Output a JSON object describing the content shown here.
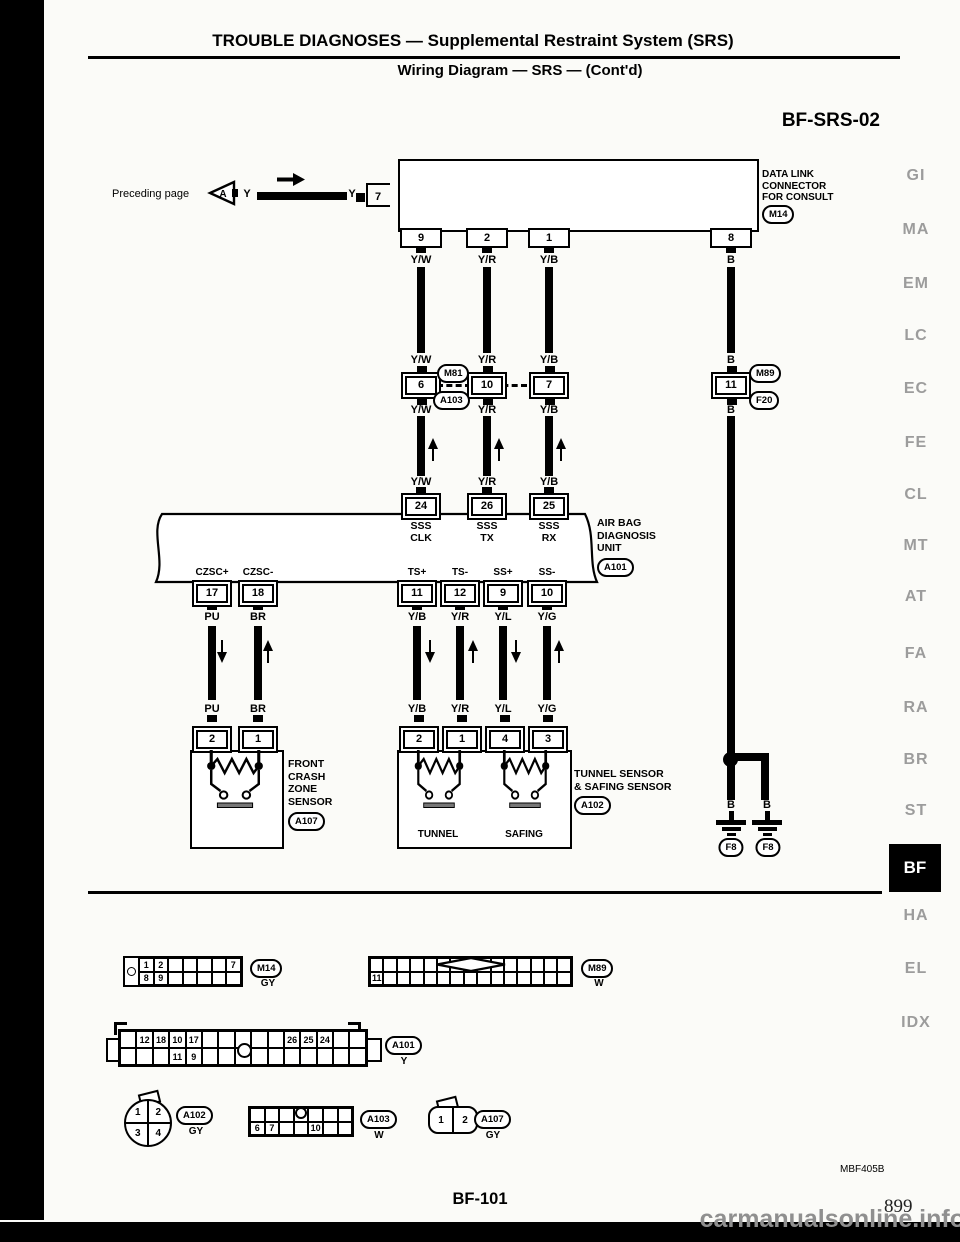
{
  "header": {
    "title": "TROUBLE DIAGNOSES — Supplemental Restraint System (SRS)",
    "subtitle": "Wiring Diagram — SRS — (Cont'd)",
    "diagram_code": "BF-SRS-02"
  },
  "margin_tabs": [
    {
      "label": "GI"
    },
    {
      "label": "MA"
    },
    {
      "label": "EM"
    },
    {
      "label": "LC"
    },
    {
      "label": "EC"
    },
    {
      "label": "FE"
    },
    {
      "label": "CL"
    },
    {
      "label": "MT"
    },
    {
      "label": "AT"
    },
    {
      "label": "FA"
    },
    {
      "label": "RA"
    },
    {
      "label": "BR"
    },
    {
      "label": "ST"
    },
    {
      "label": "BF"
    },
    {
      "label": "HA"
    },
    {
      "label": "EL"
    },
    {
      "label": "IDX"
    }
  ],
  "preceding": {
    "label": "Preceding page",
    "ref": "A",
    "wire_color": "Y",
    "wire_color2": "Y",
    "pin": "7"
  },
  "datalink": {
    "label": "DATA LINK\nCONNECTOR\nFOR CONSULT",
    "id": "M14"
  },
  "columns": [
    {
      "pin": "9",
      "color": "Y/W",
      "splice_pin": "6",
      "unit_pin": "24",
      "signal": "SSS\nCLK"
    },
    {
      "pin": "2",
      "color": "Y/R",
      "splice_pin": "10",
      "unit_pin": "26",
      "signal": "SSS\nTX"
    },
    {
      "pin": "1",
      "color": "Y/B",
      "splice_pin": "7",
      "unit_pin": "25",
      "signal": "SSS\nRX"
    },
    {
      "pin": "8",
      "color": "B",
      "splice_pin": "11"
    }
  ],
  "splice_ids": {
    "top": "M81",
    "bottom": "A103"
  },
  "right_splice_ids": {
    "top": "M89",
    "bottom": "F20"
  },
  "unit": {
    "name": "AIR BAG\nDIAGNOSIS\nUNIT",
    "id": "A101"
  },
  "unit_bottom": [
    {
      "signal": "CZSC+",
      "pin": "17",
      "color": "PU",
      "sensor_pin": "2"
    },
    {
      "signal": "CZSC-",
      "pin": "18",
      "color": "BR",
      "sensor_pin": "1"
    },
    {
      "signal": "TS+",
      "pin": "11",
      "color": "Y/B",
      "sensor_pin": "2"
    },
    {
      "signal": "TS-",
      "pin": "12",
      "color": "Y/R",
      "sensor_pin": "1"
    },
    {
      "signal": "SS+",
      "pin": "9",
      "color": "Y/L",
      "sensor_pin": "4"
    },
    {
      "signal": "SS-",
      "pin": "10",
      "color": "Y/G",
      "sensor_pin": "3"
    }
  ],
  "sensors": {
    "front": {
      "name": "FRONT\nCRASH\nZONE\nSENSOR",
      "id": "A107"
    },
    "tunnel": {
      "name": "TUNNEL SENSOR\n& SAFING SENSOR",
      "id": "A102",
      "sub_labels": [
        "TUNNEL",
        "SAFING"
      ]
    }
  },
  "ground": {
    "labels": [
      "B",
      "B"
    ],
    "ids": [
      "F8",
      "F8"
    ]
  },
  "pinouts": {
    "m14": {
      "id": "M14",
      "color": "GY",
      "cells": [
        "1",
        "2",
        "",
        "",
        "",
        "",
        "7",
        "8",
        "9",
        "",
        "",
        "",
        "",
        ""
      ]
    },
    "m89": {
      "id": "M89",
      "color": "W",
      "cells": [
        "",
        "",
        "",
        "",
        "",
        "",
        "",
        "",
        "",
        "",
        "",
        "",
        "",
        "",
        "",
        "11",
        "",
        "",
        "",
        "",
        "",
        "",
        "",
        "",
        "",
        "",
        "",
        "",
        "",
        ""
      ]
    },
    "a101": {
      "id": "A101",
      "color": "Y",
      "cells": [
        "",
        "12",
        "18",
        "10",
        "17",
        "",
        "",
        "",
        "",
        "",
        "26",
        "25",
        "24",
        "",
        "",
        "",
        "",
        "",
        "11",
        "9",
        "",
        "",
        "",
        "",
        "",
        "",
        "",
        "",
        "",
        ""
      ]
    },
    "a102": {
      "id": "A102",
      "color": "GY",
      "cells": [
        "1",
        "2",
        "3",
        "4"
      ]
    },
    "a103": {
      "id": "A103",
      "color": "W",
      "cells": [
        "",
        "",
        "",
        "",
        "",
        "",
        "",
        "6",
        "7",
        "",
        "",
        "10",
        "",
        ""
      ]
    },
    "a107": {
      "id": "A107",
      "color": "GY",
      "cells": [
        "1",
        "2"
      ]
    }
  },
  "footer": {
    "code": "MBF405B",
    "page_ref": "BF-101",
    "book_page": "899",
    "watermark": "carmanualsonline.info"
  }
}
